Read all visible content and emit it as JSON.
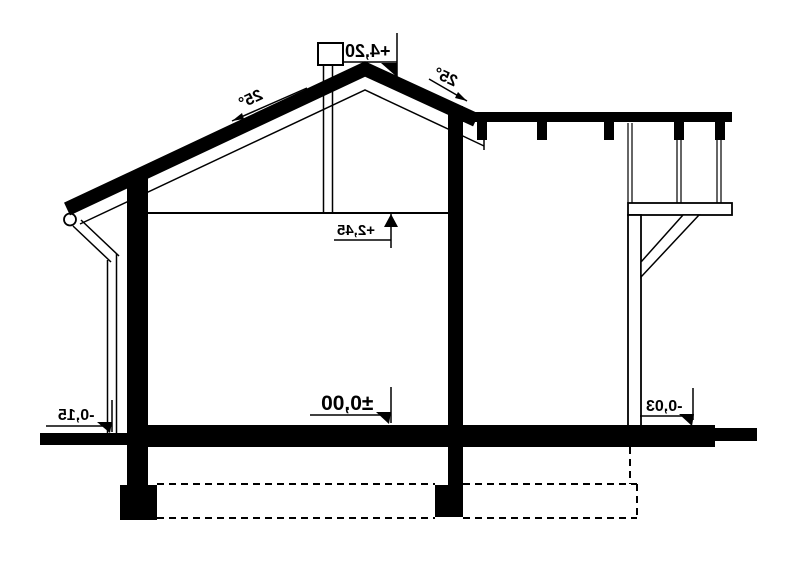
{
  "drawing": {
    "type": "house-cross-section",
    "levels": {
      "ridge_level": "+4,20",
      "ceiling_level": "+2,45",
      "floor_level": "±0,00",
      "terrace_level": "-0,15",
      "right_ground_level": "-0,03"
    },
    "angles": {
      "roof_angle_left": "25°",
      "roof_angle_right": "25°"
    },
    "colors": {
      "ink": "#000000",
      "background": "#ffffff"
    }
  }
}
